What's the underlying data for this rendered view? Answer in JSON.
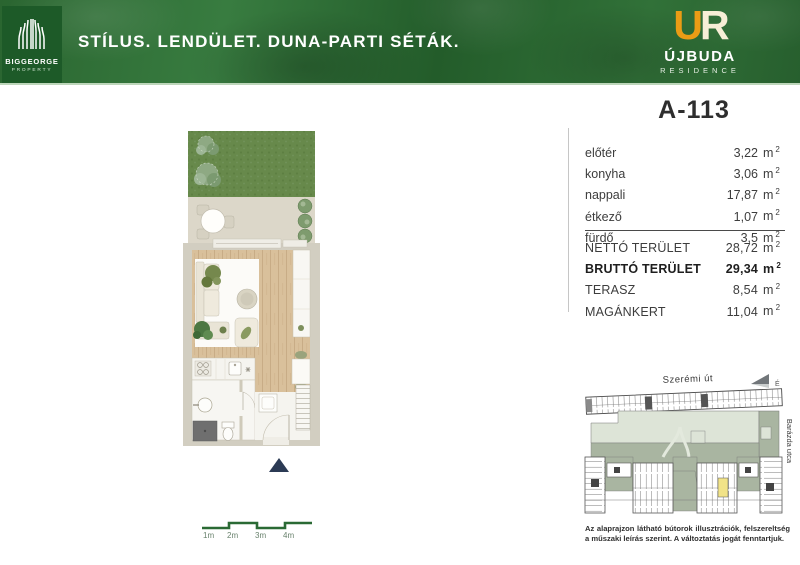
{
  "header": {
    "brand": {
      "name": "BIGGEORGE",
      "sub": "PROPERTY"
    },
    "tagline": "STÍLUS. LENDÜLET. DUNA-PARTI SÉTÁK.",
    "residence": {
      "monogram_u": "U",
      "monogram_r": "R",
      "name": "ÚJBUDA",
      "sub": "RESIDENCE"
    }
  },
  "unit": {
    "id": "A-113",
    "area_unit": "m",
    "area_sup": "2",
    "rooms": [
      {
        "name": "előtér",
        "area": "3,22"
      },
      {
        "name": "konyha",
        "area": "3,06"
      },
      {
        "name": "nappali",
        "area": "17,87"
      },
      {
        "name": "étkező",
        "area": "1,07"
      },
      {
        "name": "fürdő",
        "area": "3,5"
      }
    ],
    "totals": [
      {
        "name": "NETTÓ TERÜLET",
        "area": "28,72"
      },
      {
        "name": "BRUTTÓ TERÜLET",
        "area": "29,34"
      },
      {
        "name": "TERASZ",
        "area": "8,54"
      },
      {
        "name": "MAGÁNKERT",
        "area": "11,04"
      }
    ]
  },
  "site_map": {
    "street_top": "Szerémi út",
    "street_right": "Barázda utca",
    "compass_label": "É"
  },
  "disclaimer": "Az alaprajzon látható bútorok illusztrációk, felszereltség a műszaki leírás szerint. A változtatás jogát fenntartjuk.",
  "scale_bar": {
    "labels": [
      "1m",
      "2m",
      "3m",
      "4m"
    ]
  },
  "colors": {
    "header_green": "#2e6b35",
    "logo_box_green": "#1d5a28",
    "monogram_orange": "#ea9c15",
    "monogram_cream": "#f7eed6",
    "plan_wall": "#d2cec1",
    "wood_floor": "#d9c09b",
    "garden_green": "#67894b",
    "map_courtyard": "#dde4d7",
    "map_green": "#a9b5a1",
    "map_highlight": "#f1e388",
    "scale_green": "#2a6a34",
    "entrance_marker_navy": "#2b3a54"
  }
}
